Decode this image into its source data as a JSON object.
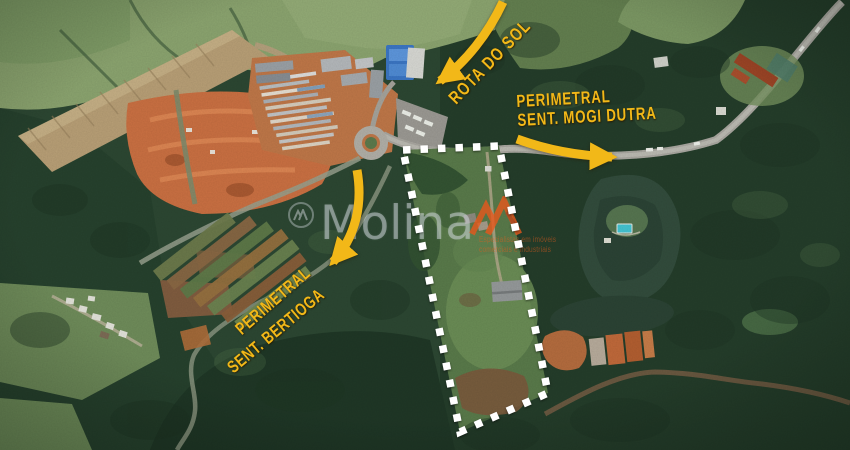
{
  "map": {
    "image_type": "satellite aerial view of rural land parcel",
    "annotations": {
      "rota_do_sol": {
        "label": "ROTA DO SOL"
      },
      "mogi_dutra": {
        "line1": "PERIMETRAL",
        "line2": "SENT. MOGI DUTRA"
      },
      "bertioga": {
        "line1": "PERIMETRAL",
        "line2": "SENT. BERTIOGA"
      }
    },
    "boundary": {
      "style": "dashed",
      "vertices": [
        [
          403,
          150
        ],
        [
          499,
          146
        ],
        [
          548,
          393
        ],
        [
          460,
          432
        ]
      ]
    }
  },
  "watermark": {
    "brand": "Molina",
    "tagline_line1": "Especialistas em imóveis",
    "tagline_line2": "comerciais e industriais"
  },
  "colors": {
    "annotation_yellow": "#F2B818",
    "boundary_white": "#FFFFFF",
    "watermark_orange": "#E85C1C"
  }
}
